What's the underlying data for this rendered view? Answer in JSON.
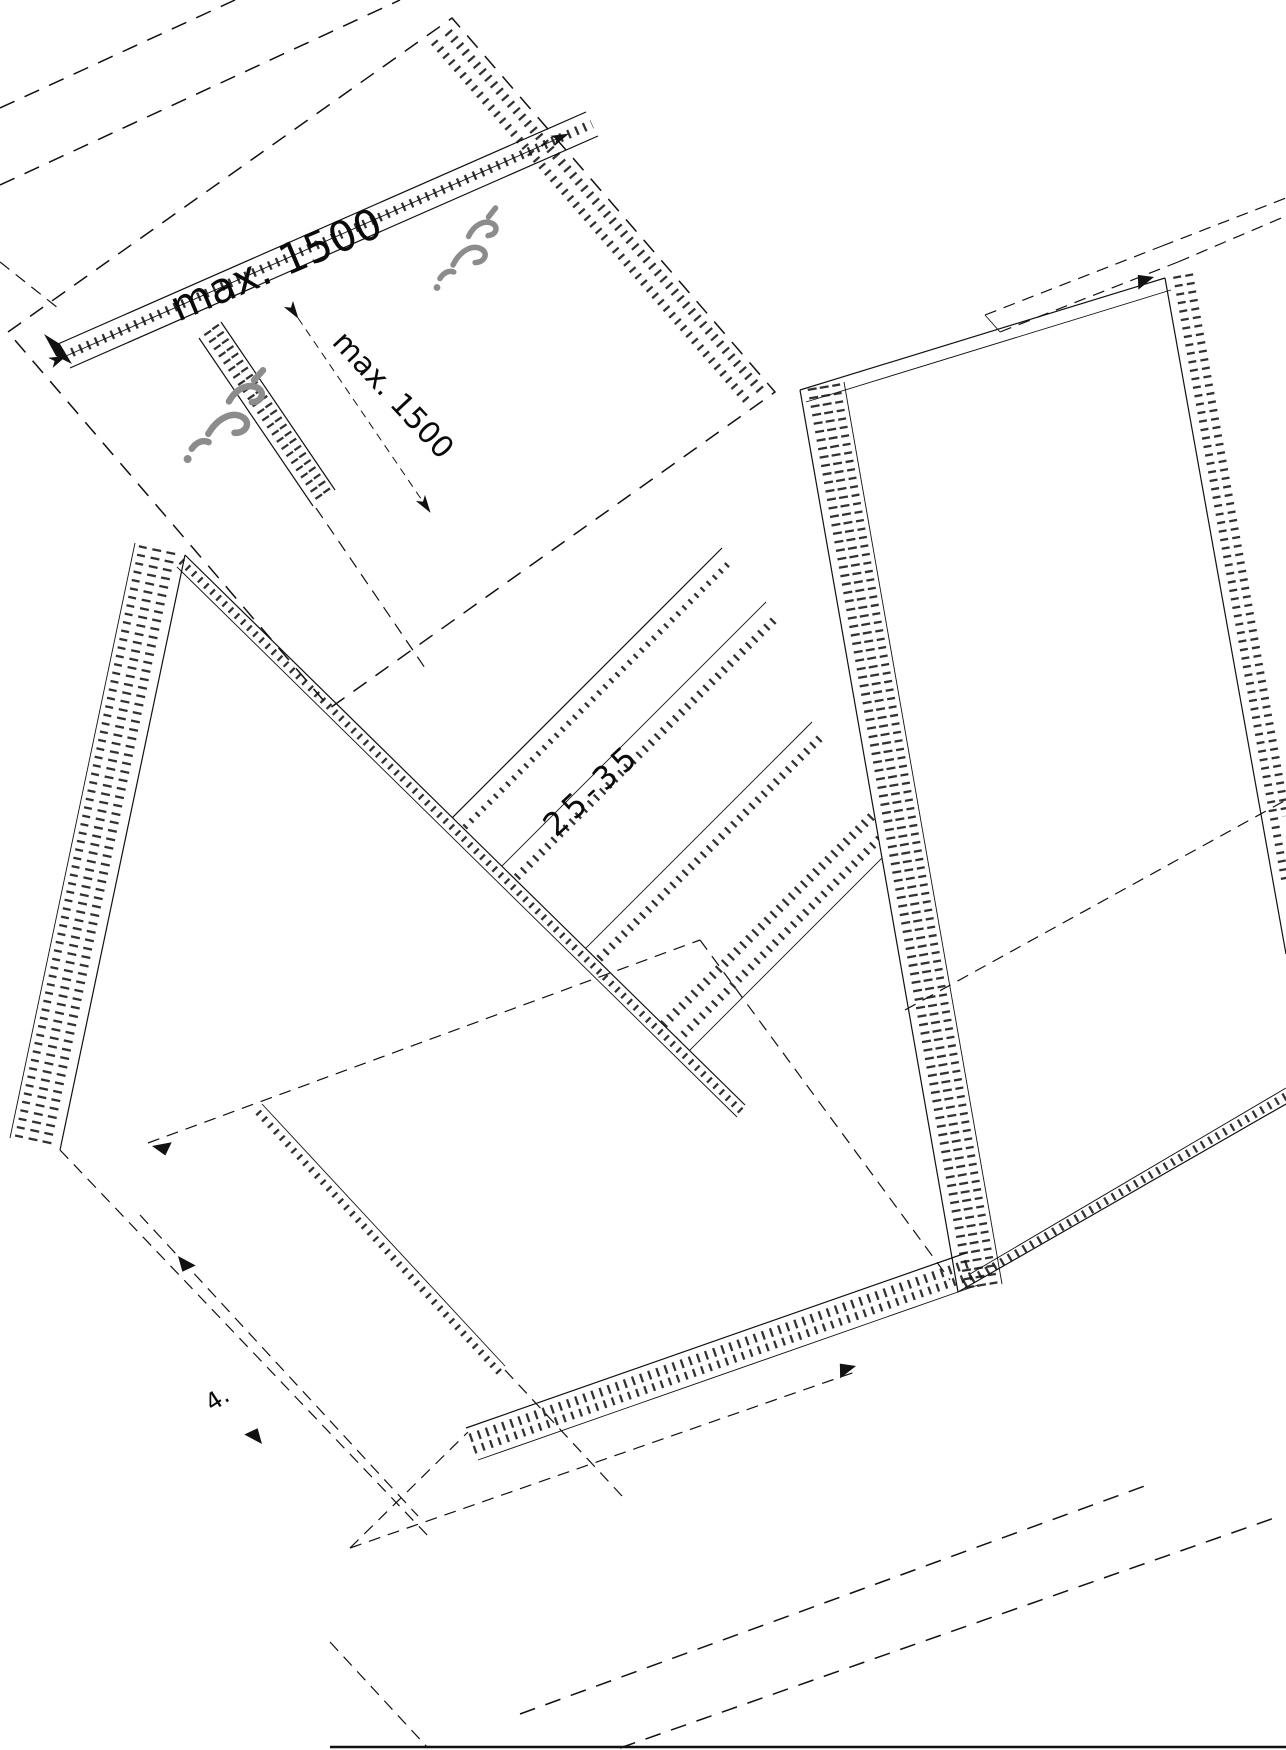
{
  "drawing": {
    "background_color": "#ffffff",
    "line_color": "#111111",
    "fastener_color": "#8c8c8c",
    "annotations": {
      "board_span_dimension": "max. 1500",
      "board_gap_dimension": "max. 1500",
      "panel_overlap_note": "25-35",
      "detail_number": "4."
    },
    "icons": {
      "fastener_1": "screw-fastener-icon",
      "fastener_2": "screw-fastener-icon",
      "direction_arrows": "arrowhead-icon"
    }
  }
}
